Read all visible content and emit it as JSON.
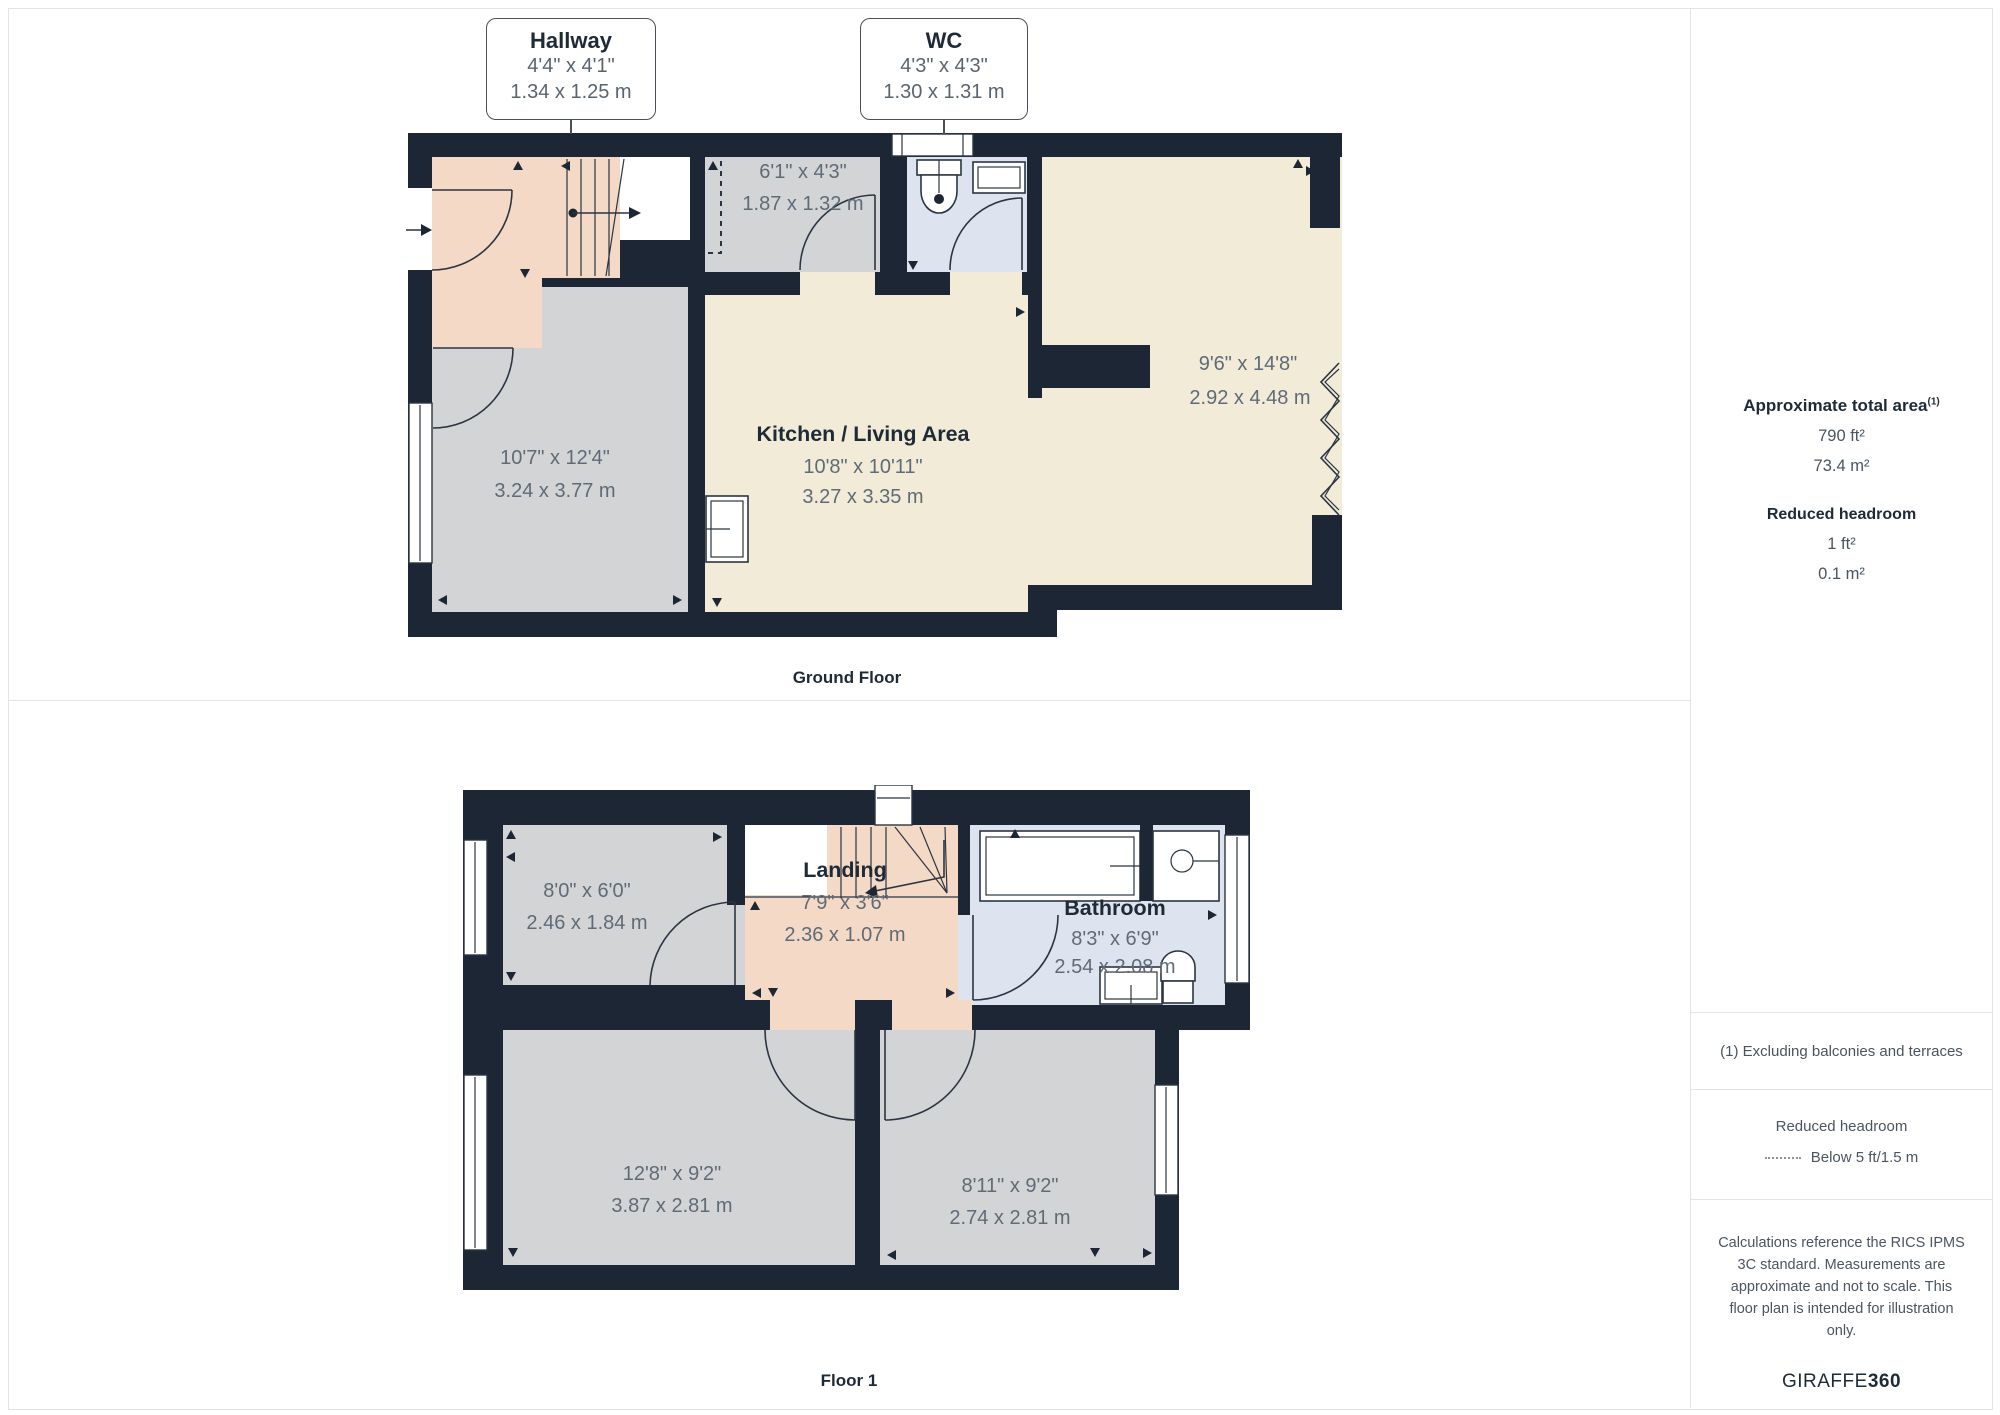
{
  "colors": {
    "wall": "#1d2634",
    "hallway_pink": "#f4d9c6",
    "room_gray": "#d3d4d6",
    "kitchen_cream": "#f1ebd7",
    "bath_blue": "#dde3ef",
    "dim_text": "#5f6b76",
    "border": "#e3e3e3"
  },
  "ground_floor": {
    "label": "Ground Floor",
    "callouts": {
      "hallway": {
        "title": "Hallway",
        "imperial": "4'4\" x 4'1\"",
        "metric": "1.34 x 1.25 m"
      },
      "wc": {
        "title": "WC",
        "imperial": "4'3\" x 4'3\"",
        "metric": "1.30 x 1.31 m"
      }
    },
    "rooms": {
      "living": {
        "imperial": "10'7\" x 12'4\"",
        "metric": "3.24 x 3.77 m"
      },
      "kitchen": {
        "name": "Kitchen / Living Area",
        "imperial": "10'8\" x 10'11\"",
        "metric": "3.27 x 3.35 m"
      },
      "storage": {
        "imperial": "6'1\" x 4'3\"",
        "metric": "1.87 x 1.32 m"
      },
      "reception": {
        "imperial": "9'6\" x 14'8\"",
        "metric": "2.92 x 4.48 m"
      }
    }
  },
  "floor1": {
    "label": "Floor 1",
    "rooms": {
      "room": {
        "imperial": "8'0\" x 6'0\"",
        "metric": "2.46 x 1.84 m"
      },
      "landing": {
        "name": "Landing",
        "imperial": "7'9\" x 3'6\"",
        "metric": "2.36 x 1.07 m"
      },
      "bathroom": {
        "name": "Bathroom",
        "imperial": "8'3\" x 6'9\"",
        "metric": "2.54 x 2.08 m"
      },
      "bedroom1": {
        "imperial": "12'8\" x 9'2\"",
        "metric": "3.87 x 2.81 m"
      },
      "bedroom2": {
        "imperial": "8'11\" x 9'2\"",
        "metric": "2.74 x 2.81 m"
      }
    }
  },
  "sidebar": {
    "area_title": "Approximate total area",
    "area_note_ref": "(1)",
    "area_sqft": "790 ft²",
    "area_sqm": "73.4 m²",
    "reduced_title": "Reduced headroom",
    "reduced_sqft": "1 ft²",
    "reduced_sqm": "0.1 m²",
    "note1": "(1) Excluding balconies and terraces",
    "legend_title": "Reduced headroom",
    "legend_text": "Below 5 ft/1.5 m",
    "disclaimer": "Calculations reference the RICS IPMS 3C standard. Measurements are approximate and not to scale. This floor plan is intended for illustration only.",
    "brand_name": "GIRAFFE",
    "brand_number": "360"
  }
}
